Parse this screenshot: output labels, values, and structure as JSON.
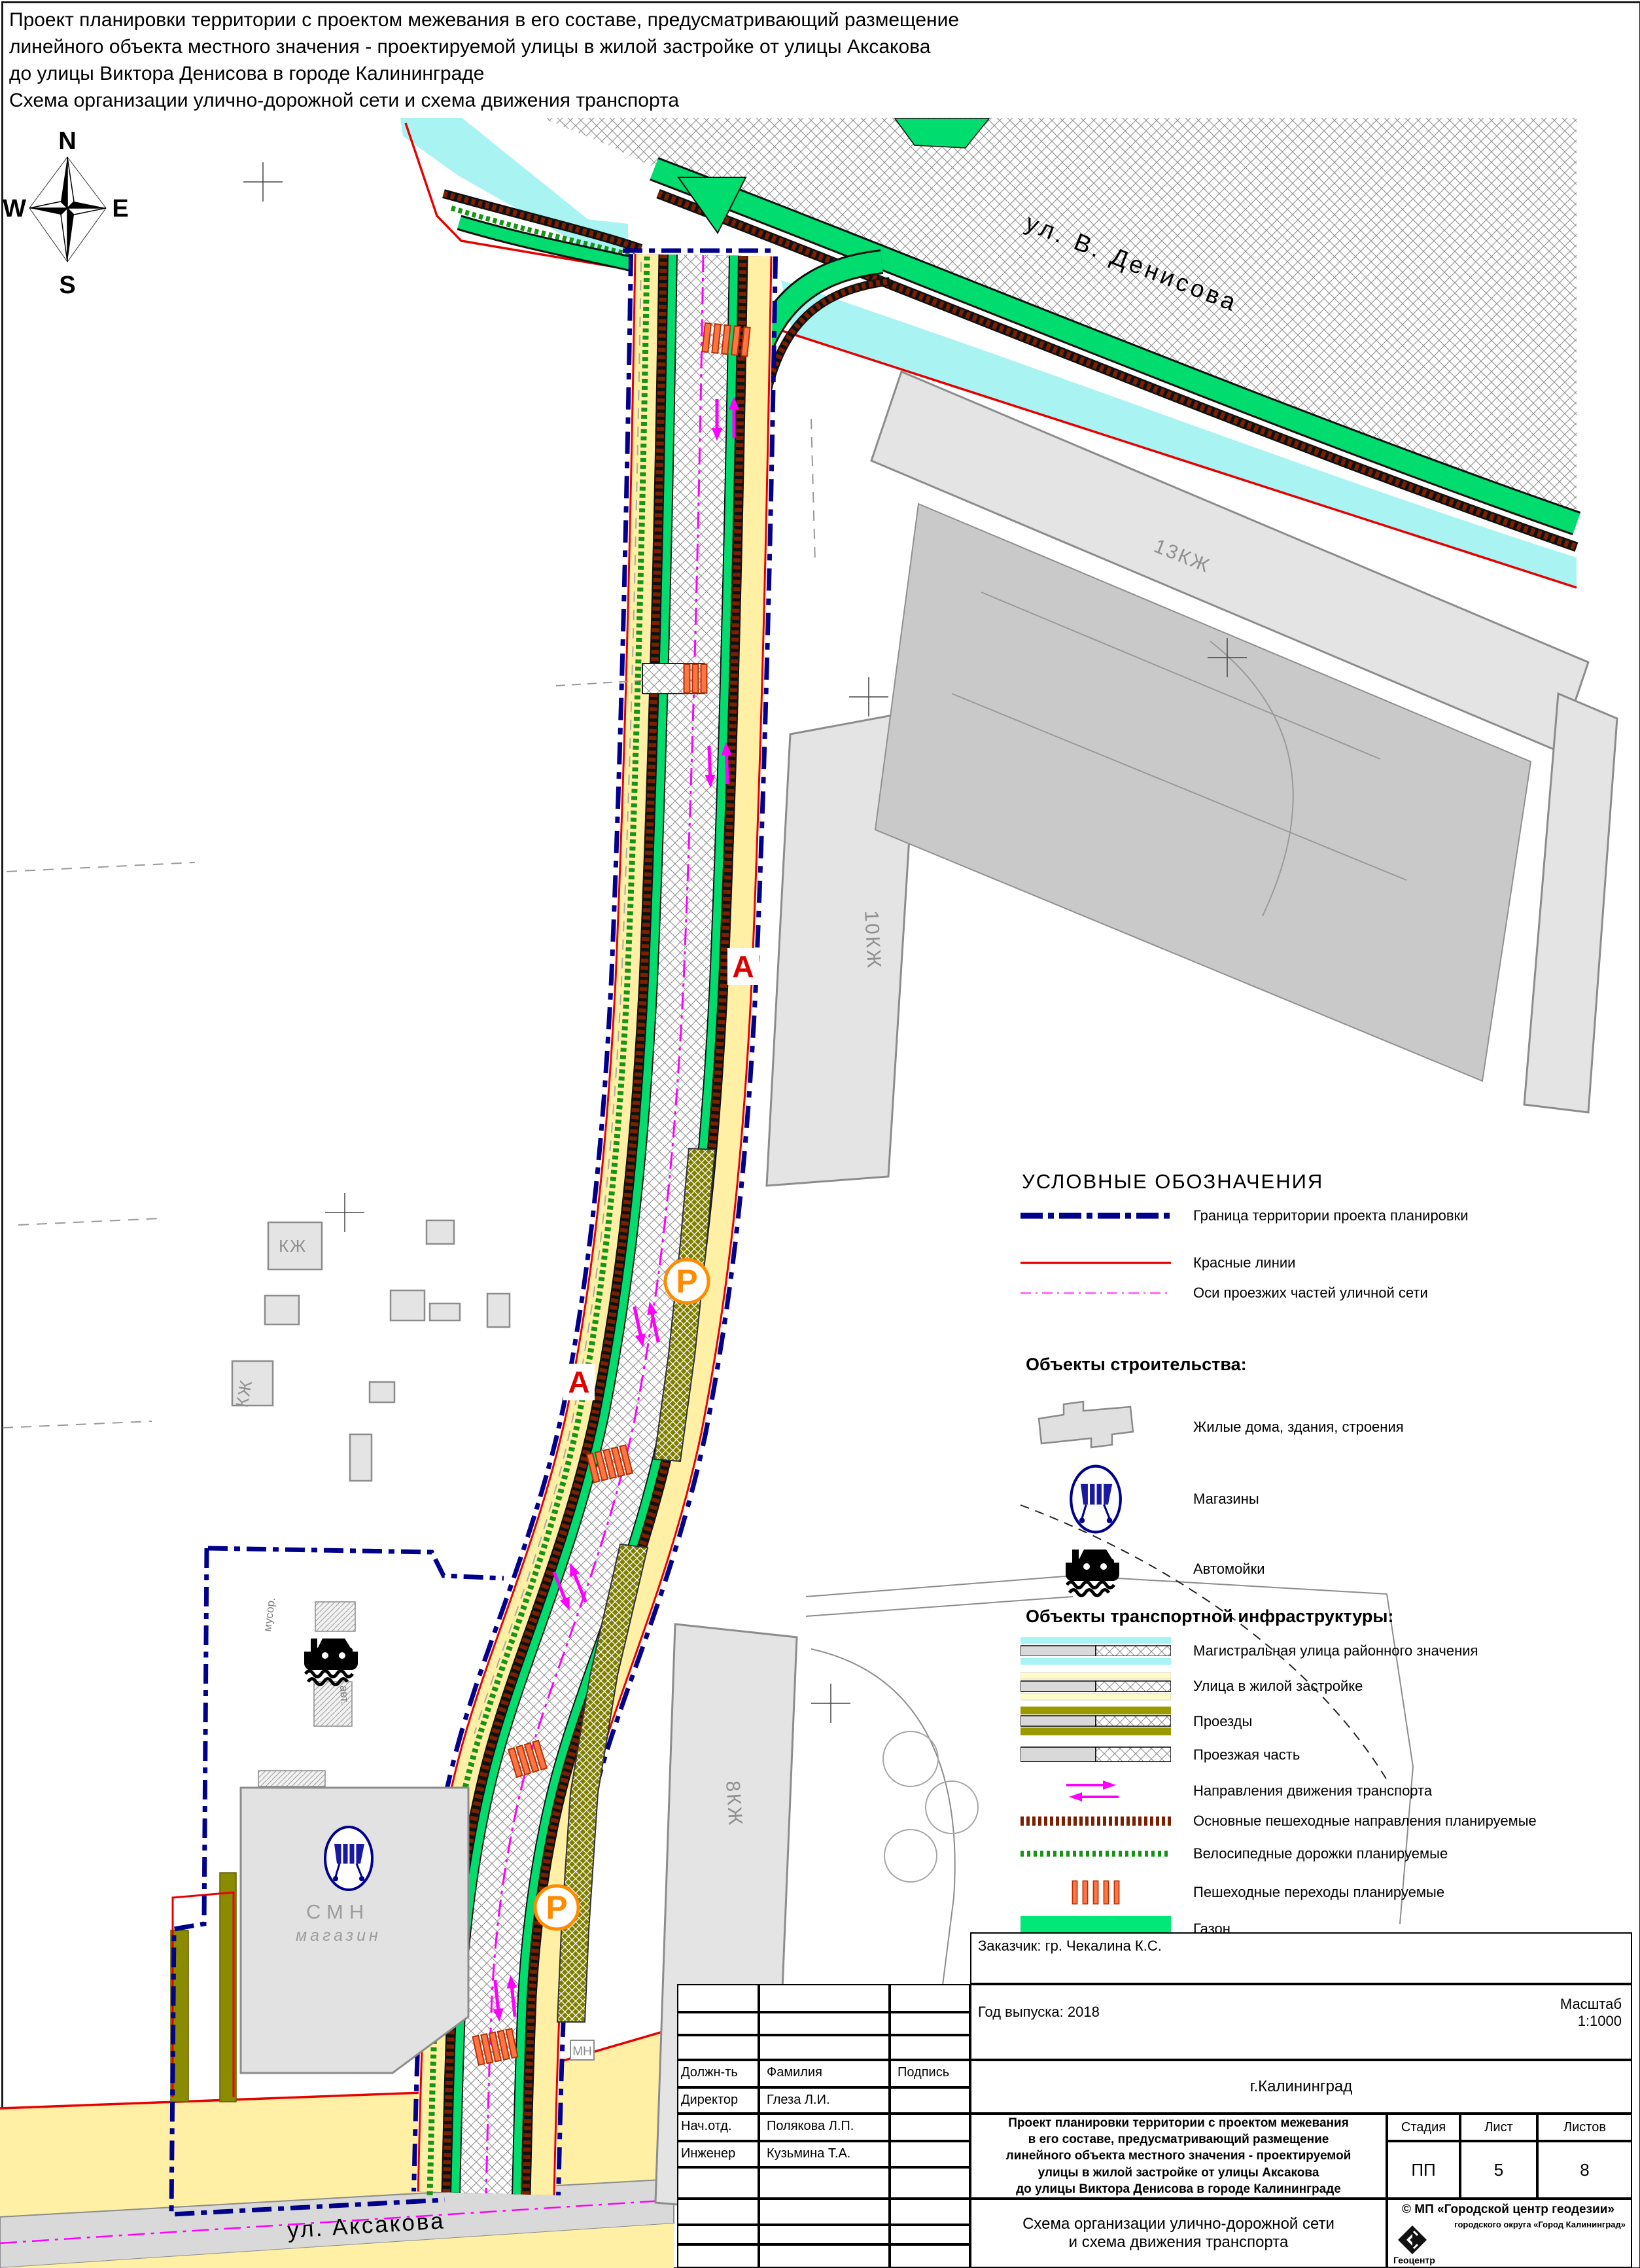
{
  "doc": {
    "title": "Проект планировки территории с проектом межевания в его составе, предусматривающий размещение\nлинейного объекта местного значения - проектируемой улицы в жилой застройке от улицы Аксакова\nдо улицы Виктора Денисова в городе Калининграде\nСхема организации улично-дорожной сети и схема движения транспорта"
  },
  "compass": {
    "n": "N",
    "s": "S",
    "w": "W",
    "e": "E"
  },
  "map": {
    "street_denisova": "ул. В. Денисова",
    "street_aksakova": "ул. Аксакова",
    "bldg_13kzh": "13КЖ",
    "bldg_10kzh": "10КЖ",
    "bldg_8kzh": "8КЖ",
    "bldg_kzh_a": "КЖ",
    "bldg_kzh_b": "КЖ",
    "bldg_smn": "СМН",
    "bldg_smn_sub": "магазин",
    "bldg_mn": "МН",
    "label_trash": "мусор.",
    "label_wash": "авт.",
    "bus_stop": "А",
    "parking": "Р"
  },
  "legend": {
    "title": "УСЛОВНЫЕ ОБОЗНАЧЕНИЯ",
    "lines": [
      {
        "label": "Граница территории проекта планировки"
      },
      {
        "label": "Красные линии"
      },
      {
        "label": "Оси проезжих частей уличной сети"
      }
    ],
    "construction": {
      "heading": "Объекты строительства:",
      "items": [
        {
          "label": "Жилые дома, здания, строения"
        },
        {
          "label": "Магазины"
        },
        {
          "label": "Автомойки"
        }
      ]
    },
    "transport": {
      "heading": "Объекты транспортной инфраструктуры:",
      "items": [
        {
          "label": "Магистральная улица районного значения"
        },
        {
          "label": "Улица в жилой застройке"
        },
        {
          "label": "Проезды"
        },
        {
          "label": "Проезжая часть"
        },
        {
          "label": "Направления движения транспорта"
        },
        {
          "label": "Основные пешеходные направления планируемые"
        },
        {
          "label": "Велосипедные дорожки планируемые"
        },
        {
          "label": "Пешеходные переходы планируемые"
        },
        {
          "label": "Газон"
        },
        {
          "label": "Автобусная остановка планируемая"
        },
        {
          "label": "Автостоянка планируемая"
        }
      ]
    }
  },
  "title_block": {
    "customer": "Заказчик: гр. Чекалина К.С.",
    "year": "Год выпуска: 2018",
    "scale": "Масштаб\n1:1000",
    "city": "г.Калининград",
    "col_position": "Должн-ть",
    "col_surname": "Фамилия",
    "col_signature": "Подпись",
    "staff": [
      {
        "role": "Директор",
        "name": "Глеза Л.И."
      },
      {
        "role": "Нач.отд.",
        "name": "Полякова Л.П."
      },
      {
        "role": "Инженер",
        "name": "Кузьмина Т.А."
      }
    ],
    "project": "Проект планировки территории с проектом межевания\nв его составе, предусматривающий размещение\nлинейного объекта местного значения - проектируемой\nулицы в жилой застройке от улицы Аксакова\nдо улицы Виктора Денисова в городе Калининграде",
    "stage_label": "Стадия",
    "sheet_label": "Лист",
    "sheets_label": "Листов",
    "stage": "ПП",
    "sheet": "5",
    "sheets": "8",
    "scheme": "Схема организации улично-дорожной сети\nи схема движения транспорта",
    "org": "© МП «Городской центр геодезии»",
    "org_sub": "городского округа «Город Калининград»",
    "org_logo": "Геоцентр"
  },
  "colors": {
    "boundary_blue": "#00008B",
    "red_line": "#E80000",
    "axis_magenta": "#FF00FF",
    "water_cyan": "#A9F3F3",
    "lawn_green": "#00DC6E",
    "street_yellow": "#FFF0A6",
    "driveway_olive": "#9A9A00",
    "ped_brown": "#7B2000",
    "bike_green": "#169416",
    "crosswalk_orange": "#FF7445",
    "parking_orange": "#FF8C00",
    "bus_red": "#DD0000"
  }
}
